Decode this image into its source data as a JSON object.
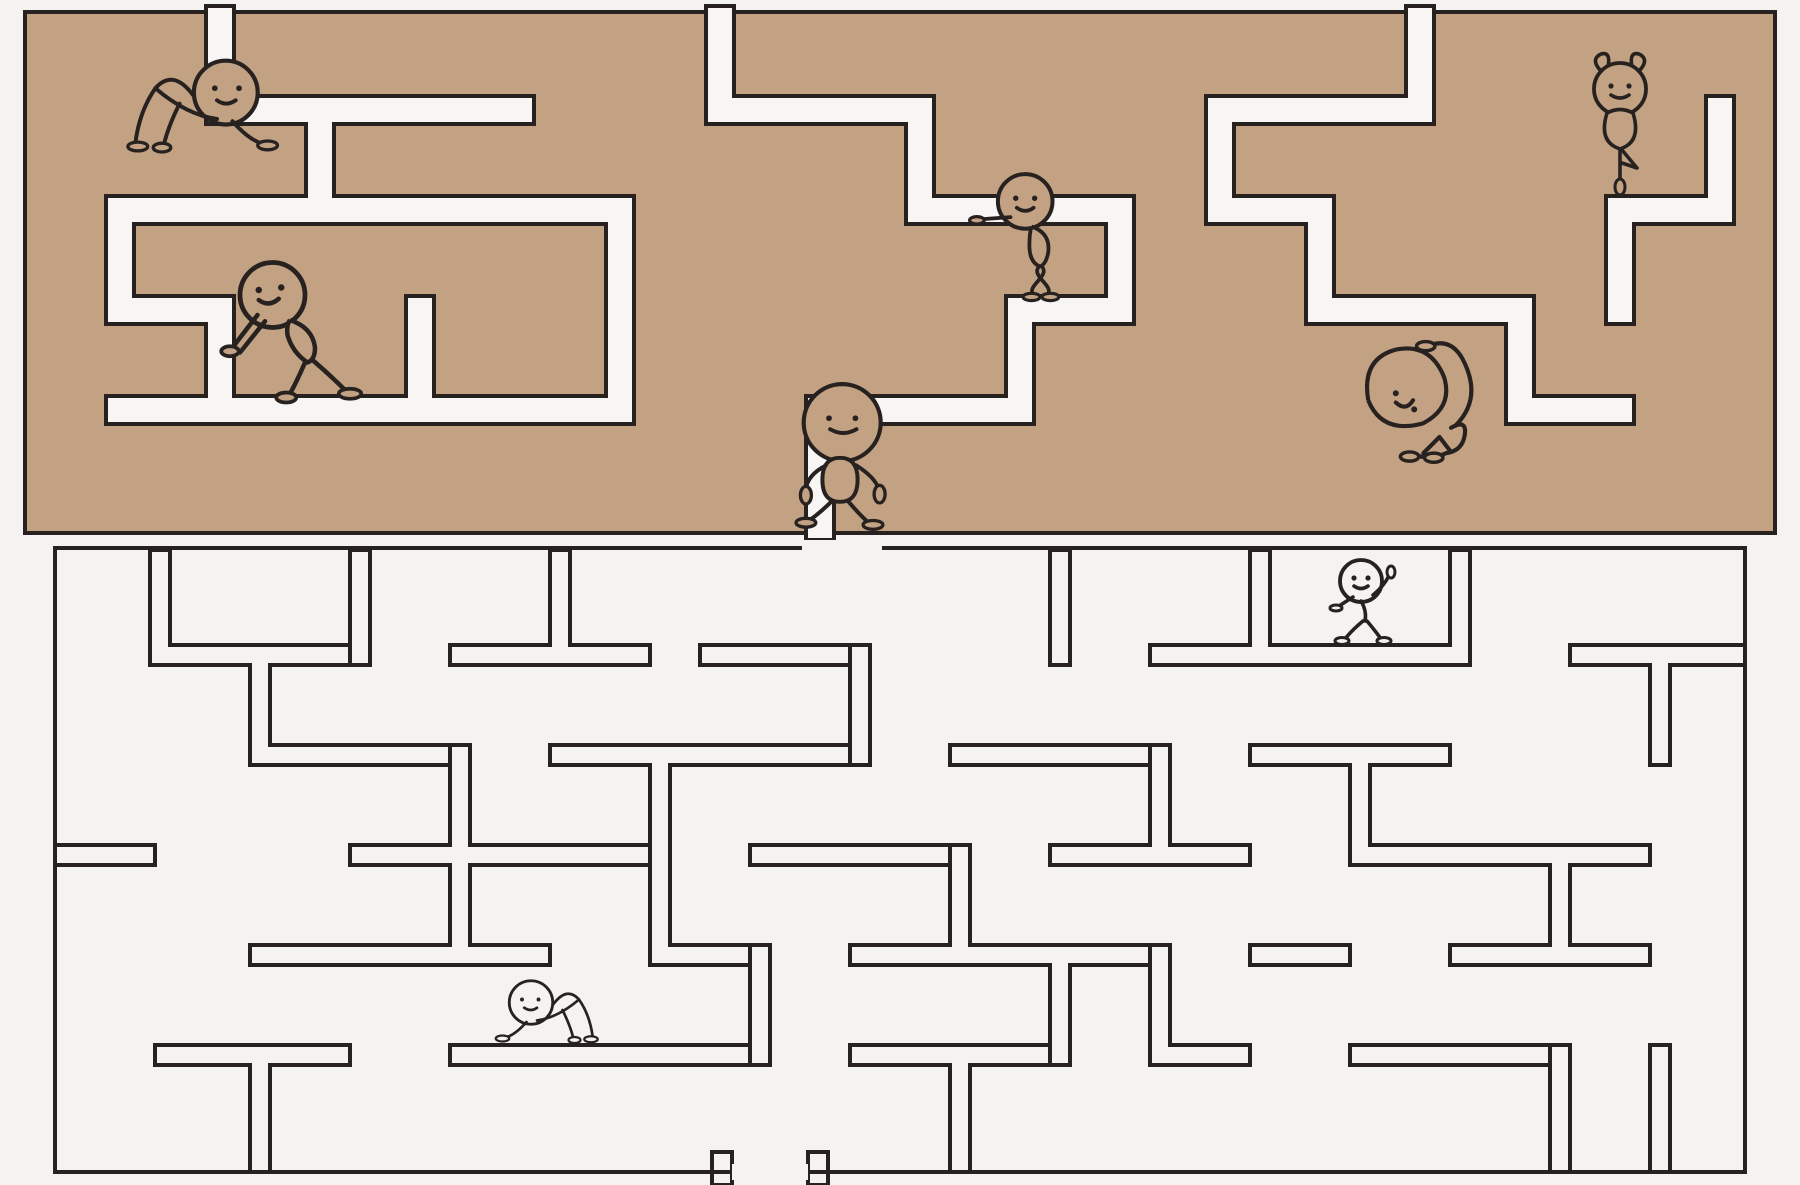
{
  "canvas": {
    "width": 1800,
    "height": 1185
  },
  "colors": {
    "background": "#f4f3f1",
    "maze_fill_tan": "#c3a284",
    "corridor_white": "#f7f6f4",
    "outline": "#272220"
  },
  "top_maze": {
    "style": "solid tan blocks with white corridors",
    "bounds": [
      25,
      12,
      1750,
      521
    ],
    "outline_width": 4,
    "corridor_width": 28,
    "corridors": [
      [
        206,
        6,
        28,
        118
      ],
      [
        206,
        96,
        328,
        28
      ],
      [
        106,
        196,
        28,
        128
      ],
      [
        106,
        296,
        128,
        28
      ],
      [
        306,
        96,
        28,
        128
      ],
      [
        106,
        196,
        528,
        28
      ],
      [
        606,
        196,
        28,
        228
      ],
      [
        406,
        396,
        228,
        28
      ],
      [
        406,
        296,
        28,
        128
      ],
      [
        206,
        296,
        28,
        128
      ],
      [
        106,
        396,
        328,
        28
      ],
      [
        706,
        6,
        28,
        118
      ],
      [
        706,
        96,
        228,
        28
      ],
      [
        906,
        96,
        28,
        128
      ],
      [
        906,
        196,
        228,
        28
      ],
      [
        1106,
        196,
        28,
        128
      ],
      [
        1006,
        296,
        128,
        28
      ],
      [
        1006,
        296,
        28,
        128
      ],
      [
        806,
        396,
        228,
        28
      ],
      [
        806,
        396,
        28,
        144
      ],
      [
        1206,
        96,
        228,
        28
      ],
      [
        1406,
        6,
        28,
        118
      ],
      [
        1206,
        96,
        28,
        128
      ],
      [
        1306,
        196,
        28,
        128
      ],
      [
        1206,
        196,
        128,
        28
      ],
      [
        1306,
        296,
        228,
        28
      ],
      [
        1506,
        296,
        28,
        128
      ],
      [
        1506,
        396,
        128,
        28
      ],
      [
        1606,
        196,
        128,
        28
      ],
      [
        1706,
        96,
        28,
        128
      ],
      [
        1606,
        196,
        28,
        128
      ]
    ]
  },
  "bottom_maze": {
    "style": "hollow outlined wall strips on white",
    "boundary": [
      55,
      548,
      1690,
      624
    ],
    "outline_width": 4,
    "wall_thickness": 20,
    "boundary_gaps": [
      [
        802,
        540,
        80,
        16
      ],
      [
        732,
        1164,
        76,
        16
      ]
    ],
    "walls": [
      [
        155,
        645,
        195,
        20
      ],
      [
        450,
        645,
        200,
        20
      ],
      [
        700,
        645,
        150,
        20
      ],
      [
        1150,
        645,
        320,
        20
      ],
      [
        1570,
        645,
        175,
        20
      ],
      [
        255,
        745,
        195,
        20
      ],
      [
        550,
        745,
        300,
        20
      ],
      [
        950,
        745,
        200,
        20
      ],
      [
        1250,
        745,
        200,
        20
      ],
      [
        55,
        845,
        100,
        20
      ],
      [
        350,
        845,
        300,
        20
      ],
      [
        750,
        845,
        200,
        20
      ],
      [
        1050,
        845,
        200,
        20
      ],
      [
        1350,
        845,
        300,
        20
      ],
      [
        250,
        945,
        300,
        20
      ],
      [
        650,
        945,
        100,
        20
      ],
      [
        850,
        945,
        300,
        20
      ],
      [
        1250,
        945,
        100,
        20
      ],
      [
        1450,
        945,
        200,
        20
      ],
      [
        155,
        1045,
        195,
        20
      ],
      [
        450,
        1045,
        300,
        20
      ],
      [
        850,
        1045,
        200,
        20
      ],
      [
        1150,
        1045,
        100,
        20
      ],
      [
        1350,
        1045,
        200,
        20
      ],
      [
        150,
        550,
        20,
        115
      ],
      [
        350,
        550,
        20,
        115
      ],
      [
        550,
        550,
        20,
        115
      ],
      [
        1050,
        550,
        20,
        115
      ],
      [
        1250,
        550,
        20,
        115
      ],
      [
        1450,
        550,
        20,
        115
      ],
      [
        250,
        645,
        20,
        120
      ],
      [
        450,
        745,
        20,
        120
      ],
      [
        650,
        745,
        20,
        220
      ],
      [
        850,
        645,
        20,
        120
      ],
      [
        950,
        845,
        20,
        120
      ],
      [
        1050,
        945,
        20,
        120
      ],
      [
        1150,
        745,
        20,
        120
      ],
      [
        1350,
        745,
        20,
        120
      ],
      [
        1550,
        845,
        20,
        120
      ],
      [
        1650,
        645,
        20,
        120
      ],
      [
        1650,
        1045,
        20,
        127
      ],
      [
        250,
        1045,
        20,
        127
      ],
      [
        450,
        845,
        20,
        120
      ],
      [
        750,
        945,
        20,
        120
      ],
      [
        950,
        1045,
        20,
        127
      ],
      [
        1150,
        945,
        20,
        120
      ],
      [
        1550,
        1045,
        20,
        127
      ],
      [
        712,
        1152,
        20,
        33
      ],
      [
        808,
        1152,
        20,
        33
      ]
    ]
  },
  "figures": [
    {
      "name": "crawling-figure-top-left",
      "pose": "crawl",
      "x": 195,
      "y": 152,
      "scale": 1.1,
      "fill": "tan",
      "mirror": false
    },
    {
      "name": "ballerina-figure",
      "pose": "ballerina",
      "x": 1620,
      "y": 194,
      "scale": 1.0,
      "fill": "tan",
      "mirror": false
    },
    {
      "name": "wall-leaning-figure",
      "pose": "lean",
      "x": 1042,
      "y": 298,
      "scale": 1.05,
      "fill": "tan",
      "mirror": false
    },
    {
      "name": "wall-pushing-figure",
      "pose": "push",
      "x": 310,
      "y": 400,
      "scale": 1.25,
      "fill": "tan",
      "mirror": false
    },
    {
      "name": "walking-figure-center",
      "pose": "walk",
      "x": 840,
      "y": 526,
      "scale": 1.1,
      "fill": "tan",
      "mirror": false
    },
    {
      "name": "big-head-resting-figure",
      "pose": "bighead",
      "x": 1428,
      "y": 460,
      "scale": 1.15,
      "fill": "tan",
      "mirror": false
    },
    {
      "name": "waving-walker-figure",
      "pose": "wave",
      "x": 1365,
      "y": 643,
      "scale": 1.0,
      "fill": "bg",
      "mirror": false
    },
    {
      "name": "crawling-figure-bottom",
      "pose": "crawl",
      "x": 552,
      "y": 1043,
      "scale": 0.75,
      "fill": "bg",
      "mirror": true
    }
  ]
}
